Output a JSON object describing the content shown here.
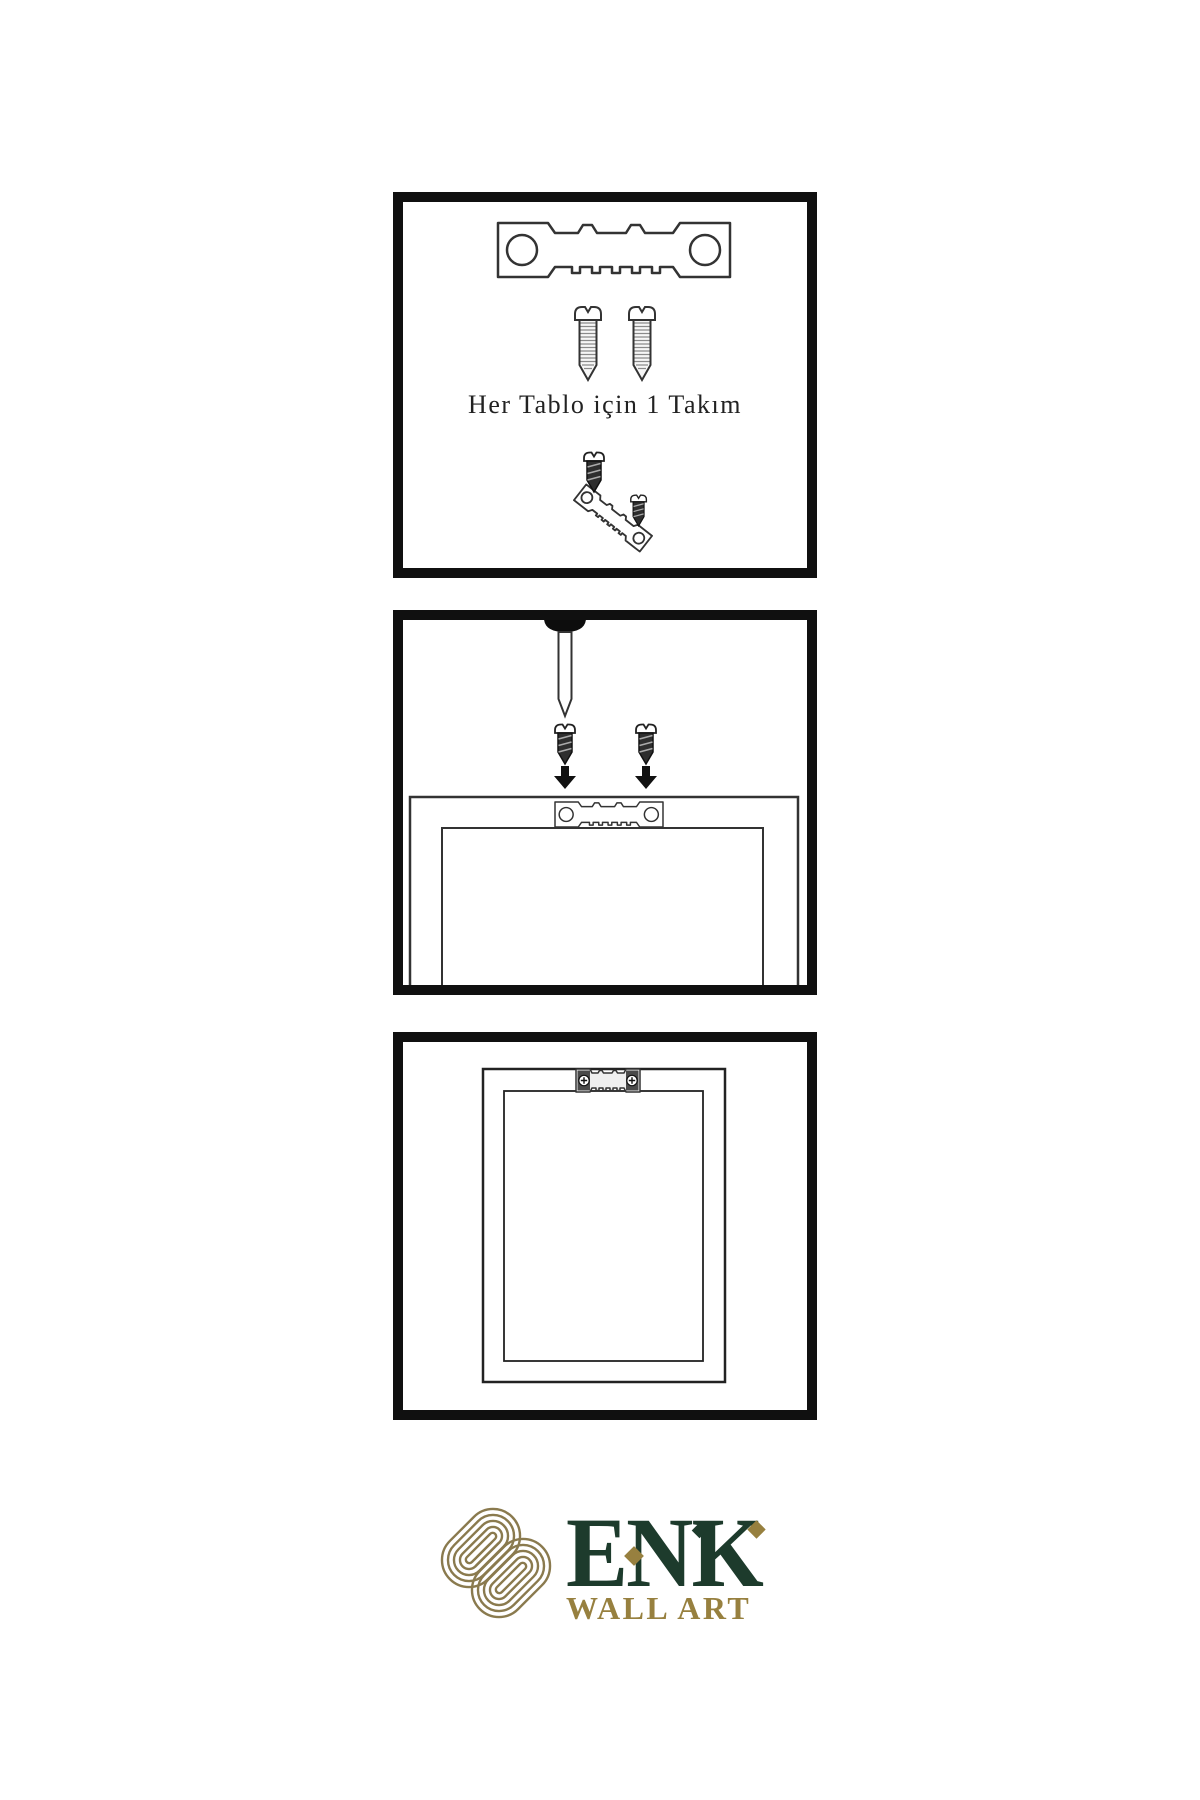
{
  "page": {
    "background": "#ffffff"
  },
  "panel1": {
    "caption": "Her Tablo için 1 Takım"
  },
  "brand": {
    "name": "ENK",
    "subtitle": "WALL ART"
  },
  "colors": {
    "panel_border": "#101010",
    "line": "#333333",
    "ink": "#222222",
    "brand_green": "#1d3b2c",
    "brand_gold": "#97803f",
    "knot_gold": "#8a7a4e"
  },
  "icons": {
    "sawtooth_hanger": "sawtooth-hanger-icon",
    "screw": "screw-icon",
    "dark_screw": "dark-screw-icon",
    "nail": "nail-icon",
    "arrow_down": "arrow-down-icon",
    "picture_frame": "picture-frame-icon",
    "knot_logo": "knot-logo-icon"
  }
}
